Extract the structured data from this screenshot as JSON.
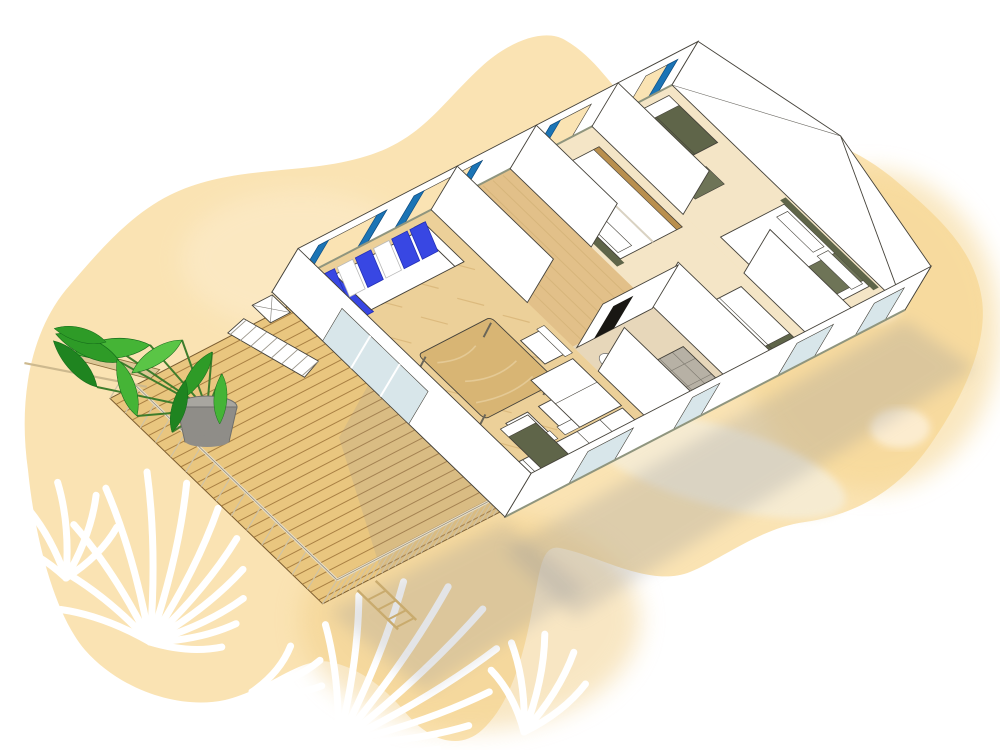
{
  "scene": {
    "kind": "watercolor-sketch 3d floor plan illustration",
    "subject": "mobile home with terrace, aerial cutaway view",
    "visible_text": [],
    "rooms": [
      "terrace-deck",
      "living-room-with-kitchen",
      "hallway",
      "shower-room",
      "bedroom",
      "master-bedroom"
    ]
  },
  "colors": {
    "outline": "#45423a",
    "white": "#ffffff",
    "blob": "#fae3b3",
    "blob_gold": "#f2cf88",
    "blob_gold2": "#f5d48d",
    "blob_light": "#fdf0d8",
    "wisp": "#f6ecd3",
    "deck_wood": "#e9c67f",
    "deck_line": "#9e7439",
    "rail": "#e6dcc4",
    "rail_post": "#cfc3a6",
    "floor_living": "#ecd099",
    "floor_hall": "#e2c089",
    "floor_bed": "#f4e5c6",
    "floor_bath": "#e7d7ba",
    "parquet": "#d0a968",
    "tile": "#b7b1a5",
    "olive": "#5f6549",
    "olive_light": "#6e7457",
    "wood": "#d8b574",
    "wood_dark": "#b98f4e",
    "blue": "#3847e3",
    "blue_dark": "#2330b8",
    "curtain": "#1b74b5",
    "curtain_dark": "#0e4f86",
    "glass": "#d8e6ea",
    "trim": "#8f957e",
    "leaf1": "#2e9b27",
    "leaf2": "#45b436",
    "leaf3": "#1f8420",
    "leaf4": "#5ac546",
    "stem": "#3f7d2c",
    "pot": "#8f8d88",
    "pot_top": "#a8a6a0",
    "shadow": "#8e9198"
  },
  "deck": {
    "plank_count": 26,
    "far_rail_posts": 15,
    "bottom_rail_posts": 28,
    "ladder_rungs": 4,
    "step_treads": 8
  },
  "sofa": {
    "back_cushions": [
      "blue",
      "blue",
      "white",
      "blue",
      "white",
      "blue",
      "blue"
    ],
    "chaise_color": "blue"
  },
  "back_wall_windows": 4,
  "front_wall_windows": 4,
  "plant": {
    "pot_center": [
      207,
      424
    ],
    "leaves": [
      {
        "x": 150,
        "y": 345,
        "r": -15,
        "s": 1.15,
        "c": "leaf2"
      },
      {
        "x": 120,
        "y": 362,
        "r": 15,
        "s": 1.05,
        "c": "leaf1"
      },
      {
        "x": 97,
        "y": 387,
        "r": 38,
        "s": 0.95,
        "c": "leaf3"
      },
      {
        "x": 182,
        "y": 340,
        "r": -42,
        "s": 0.9,
        "c": "leaf4"
      },
      {
        "x": 212,
        "y": 352,
        "r": -66,
        "s": 0.85,
        "c": "leaf1"
      },
      {
        "x": 137,
        "y": 416,
        "r": 62,
        "s": 0.9,
        "c": "leaf2"
      },
      {
        "x": 172,
        "y": 432,
        "r": 96,
        "s": 0.8,
        "c": "leaf3"
      },
      {
        "x": 222,
        "y": 374,
        "r": -96,
        "s": 0.75,
        "c": "leaf2"
      },
      {
        "x": 106,
        "y": 342,
        "r": 6,
        "s": 0.8,
        "c": "leaf1"
      }
    ]
  },
  "palms": {
    "clusters": [
      {
        "base": [
          150,
          642
        ],
        "blades": [
          {
            "a": -160,
            "l": 95
          },
          {
            "a": -141,
            "l": 115
          },
          {
            "a": -123,
            "l": 140
          },
          {
            "a": -106,
            "l": 160
          },
          {
            "a": -91,
            "l": 170
          },
          {
            "a": -77,
            "l": 163
          },
          {
            "a": -63,
            "l": 150
          },
          {
            "a": -50,
            "l": 135
          },
          {
            "a": -38,
            "l": 118
          },
          {
            "a": -25,
            "l": 103
          },
          {
            "a": -12,
            "l": 88
          },
          {
            "a": 4,
            "l": 72
          }
        ]
      },
      {
        "base": [
          66,
          578
        ],
        "blades": [
          {
            "a": -150,
            "l": 70
          },
          {
            "a": -120,
            "l": 88
          },
          {
            "a": -95,
            "l": 96
          },
          {
            "a": -70,
            "l": 88
          },
          {
            "a": -45,
            "l": 72
          }
        ]
      },
      {
        "base": [
          338,
          744
        ],
        "blades": [
          {
            "a": -96,
            "l": 120
          },
          {
            "a": -82,
            "l": 150
          },
          {
            "a": -68,
            "l": 175
          },
          {
            "a": -55,
            "l": 192
          },
          {
            "a": -43,
            "l": 198
          },
          {
            "a": -31,
            "l": 185
          },
          {
            "a": -19,
            "l": 160
          },
          {
            "a": -8,
            "l": 132
          },
          {
            "a": 3,
            "l": 100
          }
        ]
      },
      {
        "base": [
          524,
          732
        ],
        "blades": [
          {
            "a": -118,
            "l": 70
          },
          {
            "a": -98,
            "l": 90
          },
          {
            "a": -78,
            "l": 100
          },
          {
            "a": -58,
            "l": 94
          },
          {
            "a": -38,
            "l": 78
          }
        ]
      },
      {
        "base": [
          252,
          692
        ],
        "blades": [
          {
            "a": -50,
            "l": 60
          },
          {
            "a": -25,
            "l": 75
          },
          {
            "a": -5,
            "l": 70
          },
          {
            "a": 15,
            "l": 55
          }
        ]
      }
    ]
  }
}
